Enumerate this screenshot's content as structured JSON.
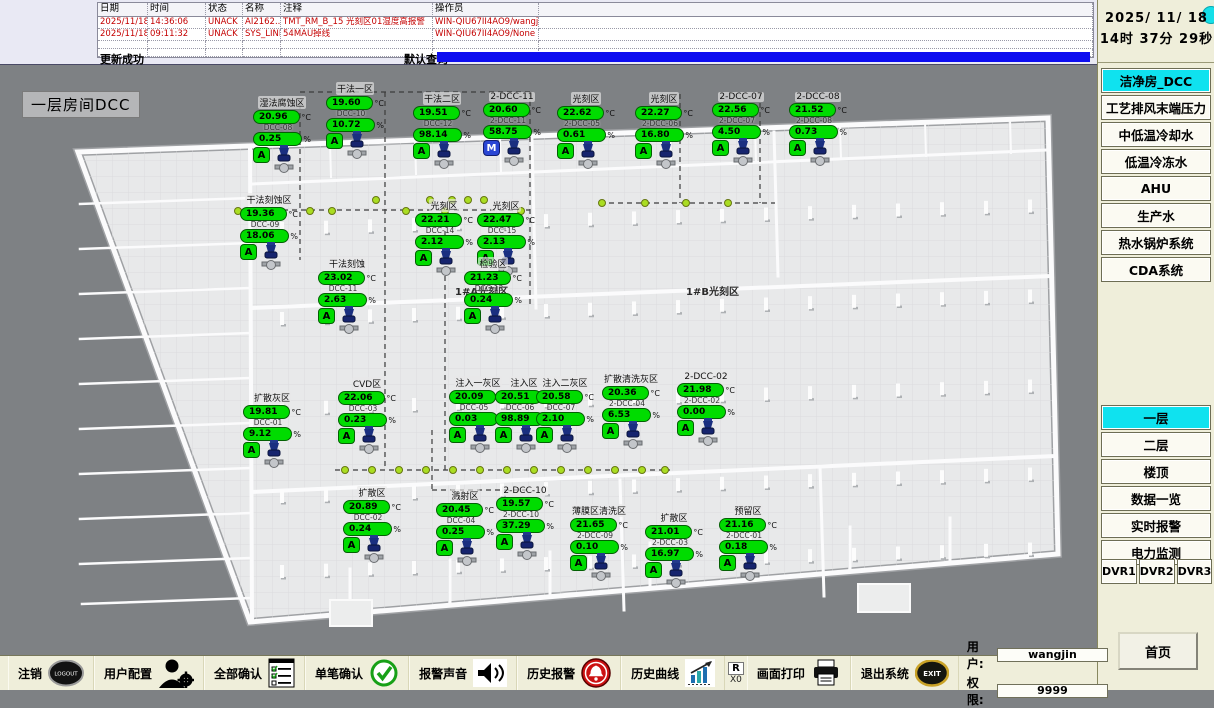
{
  "alarm_table": {
    "headers": [
      "日期",
      "时间",
      "状态",
      "名称",
      "注释",
      "操作员",
      ""
    ],
    "rows": [
      [
        "2025/11/18",
        "14:36:06",
        "UNACK",
        "AI2162...",
        "TMT_RM_B_15 光刻区01湿度高报警",
        "WIN-QIU67II4AO9/wangjin",
        ""
      ],
      [
        "2025/11/18",
        "09:11:32",
        "UNACK",
        "SYS_LINK6",
        "54MAU掉线",
        "WIN-QIU67II4AO9/None",
        ""
      ]
    ],
    "status_left": "更新成功",
    "status_right": "默认查询"
  },
  "clock": {
    "date": "2025/ 11/ 18",
    "time": "14时 37分 29秒"
  },
  "sidebar": {
    "systems": [
      {
        "label": "洁净房_DCC",
        "active": true
      },
      {
        "label": "工艺排风末端压力",
        "active": false
      },
      {
        "label": "中低温冷却水",
        "active": false
      },
      {
        "label": "低温冷冻水",
        "active": false
      },
      {
        "label": "AHU",
        "active": false
      },
      {
        "label": "生产水",
        "active": false
      },
      {
        "label": "热水锅炉系统",
        "active": false
      },
      {
        "label": "CDA系统",
        "active": false
      }
    ],
    "views": [
      {
        "label": "一层",
        "active": true
      },
      {
        "label": "二层",
        "active": false
      },
      {
        "label": "楼顶",
        "active": false
      },
      {
        "label": "数据一览",
        "active": false
      },
      {
        "label": "实时报警",
        "active": false
      },
      {
        "label": "电力监测",
        "active": false
      }
    ],
    "dvr": [
      "DVR1",
      "DVR2",
      "DVR3"
    ],
    "home": "首页"
  },
  "toolbar": {
    "buttons": [
      {
        "label": "注销",
        "icon": "logout-icon"
      },
      {
        "label": "用户配置",
        "icon": "user-config-icon"
      },
      {
        "label": "全部确认",
        "icon": "confirm-all-icon"
      },
      {
        "label": "单笔确认",
        "icon": "confirm-single-icon"
      },
      {
        "label": "报警声音",
        "icon": "alarm-sound-icon"
      },
      {
        "label": "历史报警",
        "icon": "history-alarm-icon"
      },
      {
        "label": "历史曲线",
        "icon": "history-curve-icon"
      },
      {
        "label": "画面打印",
        "icon": "print-icon"
      },
      {
        "label": "退出系统",
        "icon": "exit-icon"
      }
    ],
    "counter": {
      "r": "R",
      "x": "X0"
    },
    "user_label": "用户:",
    "user_value": "wangjin",
    "priv_label": "权限:",
    "priv_value": "9999"
  },
  "plan": {
    "title": "一层房间DCC",
    "units": {
      "temp": "°C",
      "humidity": "%"
    },
    "hall_labels": [
      {
        "text": "1#A光刻区",
        "x": 455,
        "y": 283
      },
      {
        "text": "1#B光刻区",
        "x": 686,
        "y": 283
      }
    ],
    "sensors": [
      {
        "name": "湿法腐蚀区",
        "temp": "20.96",
        "code": "DCC-08",
        "hum": "0.25",
        "mode": "A",
        "x": 253,
        "y": 96
      },
      {
        "name": "干法一区",
        "temp": "19.60",
        "code": "DCC-10",
        "hum": "10.72",
        "mode": "A",
        "x": 326,
        "y": 82
      },
      {
        "name": "干法二区",
        "temp": "19.51",
        "code": "DCC-12",
        "hum": "98.14",
        "mode": "A",
        "x": 413,
        "y": 92
      },
      {
        "name": "2-DCC-11",
        "temp": "20.60",
        "code": "2-DCC-11",
        "hum": "58.75",
        "mode": "M",
        "x": 483,
        "y": 92
      },
      {
        "name": "光刻区",
        "temp": "22.62",
        "code": "2-DCC-05",
        "hum": "0.61",
        "mode": "A",
        "x": 557,
        "y": 92
      },
      {
        "name": "光刻区",
        "temp": "22.27",
        "code": "2-DCC-06",
        "hum": "16.80",
        "mode": "A",
        "x": 635,
        "y": 92
      },
      {
        "name": "2-DCC-07",
        "temp": "22.56",
        "code": "2-DCC-07",
        "hum": "4.50",
        "mode": "A",
        "x": 712,
        "y": 92
      },
      {
        "name": "2-DCC-08",
        "temp": "21.52",
        "code": "2-DCC-08",
        "hum": "0.73",
        "mode": "A",
        "x": 789,
        "y": 92
      },
      {
        "name": "干法刻蚀区",
        "temp": "19.36",
        "code": "DCC-09",
        "hum": "18.06",
        "mode": "A",
        "x": 240,
        "y": 193
      },
      {
        "name": "光刻区",
        "temp": "22.21",
        "code": "DCC-14",
        "hum": "2.12",
        "mode": "A",
        "x": 415,
        "y": 199
      },
      {
        "name": "光刻区",
        "temp": "22.47",
        "code": "DCC-15",
        "hum": "2.13",
        "mode": "A",
        "x": 477,
        "y": 199
      },
      {
        "name": "干法刻蚀",
        "temp": "23.02",
        "code": "DCC-11",
        "hum": "2.63",
        "mode": "A",
        "x": 318,
        "y": 257
      },
      {
        "name": "检验区",
        "temp": "21.23",
        "code": "DCC-13",
        "hum": "0.24",
        "mode": "A",
        "x": 464,
        "y": 257
      },
      {
        "name": "扩散灰区",
        "temp": "19.81",
        "code": "DCC-01",
        "hum": "9.12",
        "mode": "A",
        "x": 243,
        "y": 391
      },
      {
        "name": "CVD区",
        "temp": "22.06",
        "code": "DCC-03",
        "hum": "0.23",
        "mode": "A",
        "x": 338,
        "y": 377
      },
      {
        "name": "注入一灰区",
        "temp": "20.09",
        "code": "DCC-05",
        "hum": "0.03",
        "mode": "A",
        "x": 449,
        "y": 376
      },
      {
        "name": "注入区",
        "temp": "20.51",
        "code": "DCC-06",
        "hum": "98.89",
        "mode": "A",
        "x": 495,
        "y": 376
      },
      {
        "name": "注入二灰区",
        "temp": "20.58",
        "code": "DCC-07",
        "hum": "2.10",
        "mode": "A",
        "x": 536,
        "y": 376
      },
      {
        "name": "扩散清洗灰区",
        "temp": "20.36",
        "code": "2-DCC-04",
        "hum": "6.53",
        "mode": "A",
        "x": 602,
        "y": 372
      },
      {
        "name": "2-DCC-02",
        "temp": "21.98",
        "code": "2-DCC-02",
        "hum": "0.00",
        "mode": "A",
        "x": 677,
        "y": 372
      },
      {
        "name": "扩散区",
        "temp": "20.89",
        "code": "DCC-02",
        "hum": "0.24",
        "mode": "A",
        "x": 343,
        "y": 486
      },
      {
        "name": "溅射区",
        "temp": "20.45",
        "code": "DCC-04",
        "hum": "0.25",
        "mode": "A",
        "x": 436,
        "y": 489
      },
      {
        "name": "2-DCC-10",
        "temp": "19.57",
        "code": "2-DCC-10",
        "hum": "37.29",
        "mode": "A",
        "x": 496,
        "y": 486
      },
      {
        "name": "薄膜区清洗区",
        "temp": "21.65",
        "code": "2-DCC-09",
        "hum": "0.10",
        "mode": "A",
        "x": 570,
        "y": 504
      },
      {
        "name": "扩散区",
        "temp": "21.01",
        "code": "2-DCC-03",
        "hum": "16.97",
        "mode": "A",
        "x": 645,
        "y": 511
      },
      {
        "name": "预留区",
        "temp": "21.16",
        "code": "2-DCC-01",
        "hum": "0.18",
        "mode": "A",
        "x": 719,
        "y": 504
      }
    ],
    "dots": [
      [
        238,
        211
      ],
      [
        310,
        211
      ],
      [
        332,
        211
      ],
      [
        406,
        211
      ],
      [
        445,
        211
      ],
      [
        521,
        211
      ],
      [
        376,
        200
      ],
      [
        430,
        200
      ],
      [
        452,
        200
      ],
      [
        468,
        200
      ],
      [
        484,
        200
      ],
      [
        602,
        203
      ],
      [
        645,
        203
      ],
      [
        686,
        203
      ],
      [
        728,
        203
      ],
      [
        345,
        470
      ],
      [
        372,
        470
      ],
      [
        399,
        470
      ],
      [
        426,
        470
      ],
      [
        453,
        470
      ],
      [
        480,
        470
      ],
      [
        507,
        470
      ],
      [
        534,
        470
      ],
      [
        561,
        470
      ],
      [
        588,
        470
      ],
      [
        615,
        470
      ],
      [
        642,
        470
      ],
      [
        665,
        470
      ]
    ]
  }
}
